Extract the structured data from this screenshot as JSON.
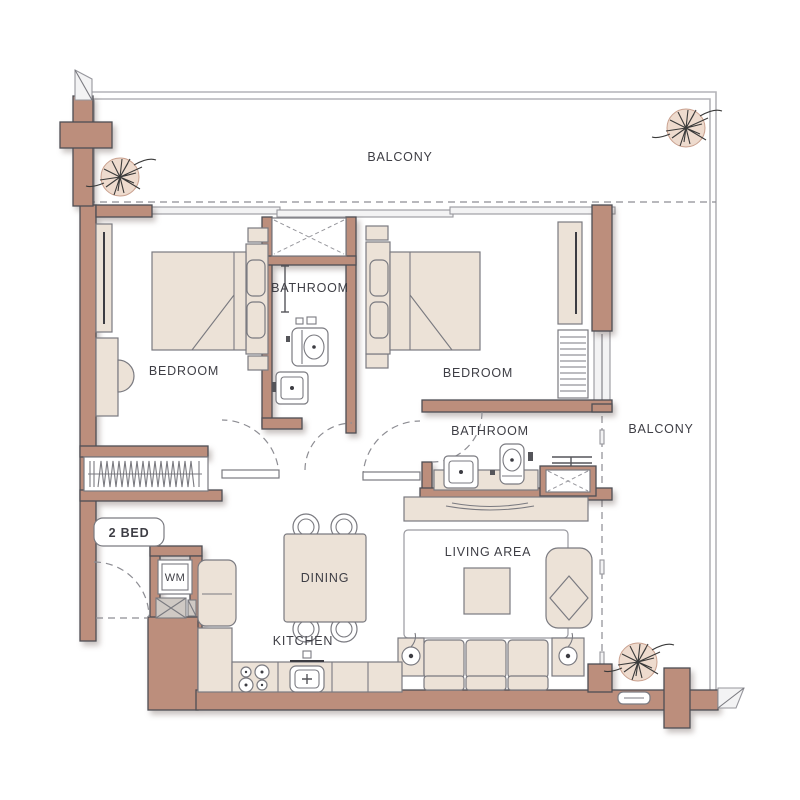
{
  "plan": {
    "badge": {
      "label": "2 BED"
    },
    "labels": {
      "balcony_top": "BALCONY",
      "balcony_right": "BALCONY",
      "bathroom_top": "BATHROOM",
      "bathroom_mid": "BATHROOM",
      "bedroom_left": "BEDROOM",
      "bedroom_right": "BEDROOM",
      "dining": "DINING",
      "kitchen": "KITCHEN",
      "living_area": "LIVING AREA",
      "washing_machine": "WM"
    },
    "colors": {
      "wall": "#bc8e7c",
      "wall_stroke": "#4e4e54",
      "furniture": "#ece2d7",
      "furniture_stroke": "#7a7a80",
      "balcony_line": "#b4b4b8",
      "label": "#3e3e45",
      "background": "#ffffff"
    }
  }
}
